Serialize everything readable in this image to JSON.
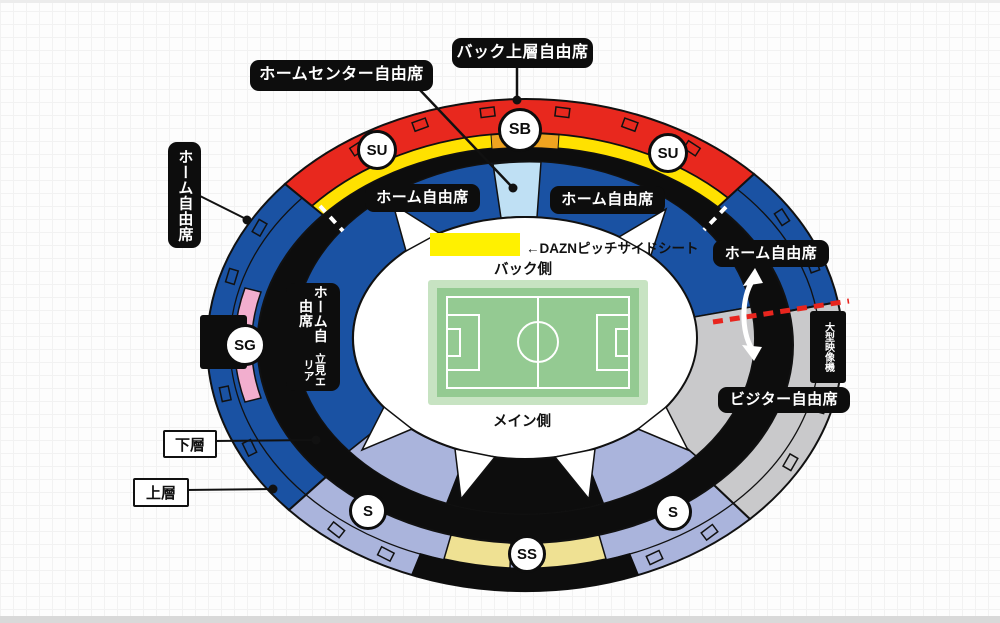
{
  "labels": {
    "back_upper": "バック上層自由席",
    "home_center": "ホームセンター自由席",
    "home_left": "ホーム自由席",
    "home_inner_left": "ホーム自由席",
    "home_inner_right": "ホーム自由席",
    "home_right": "ホーム自由席",
    "visitor": "ビジター自由席",
    "standing_line1": "ホーム自由席",
    "standing_line2": "立見エリア",
    "screen": "大型映像機",
    "lower_tier": "下層",
    "upper_tier": "上層"
  },
  "pitch": {
    "back_side": "バック側",
    "main_side": "メイン側",
    "dazn": "←DAZNピッチサイドシート"
  },
  "badges": {
    "sb": "SB",
    "su": "SU",
    "sg": "SG",
    "s": "S",
    "ss": "SS"
  },
  "colors": {
    "red": "#e8281e",
    "yellow": "#ffe100",
    "orange": "#f0a420",
    "blue": "#1a52a3",
    "light_blue": "#bfe0f4",
    "lavender": "#aab4dc",
    "gray": "#c9c9cb",
    "pink": "#f2aece",
    "khaki": "#efe193",
    "dazn_yellow": "#fff100",
    "pitch_border": "#c7e3c2",
    "pitch_green": "#94ca92",
    "black": "#0d0d0d",
    "dashed_red": "#e8251e"
  }
}
